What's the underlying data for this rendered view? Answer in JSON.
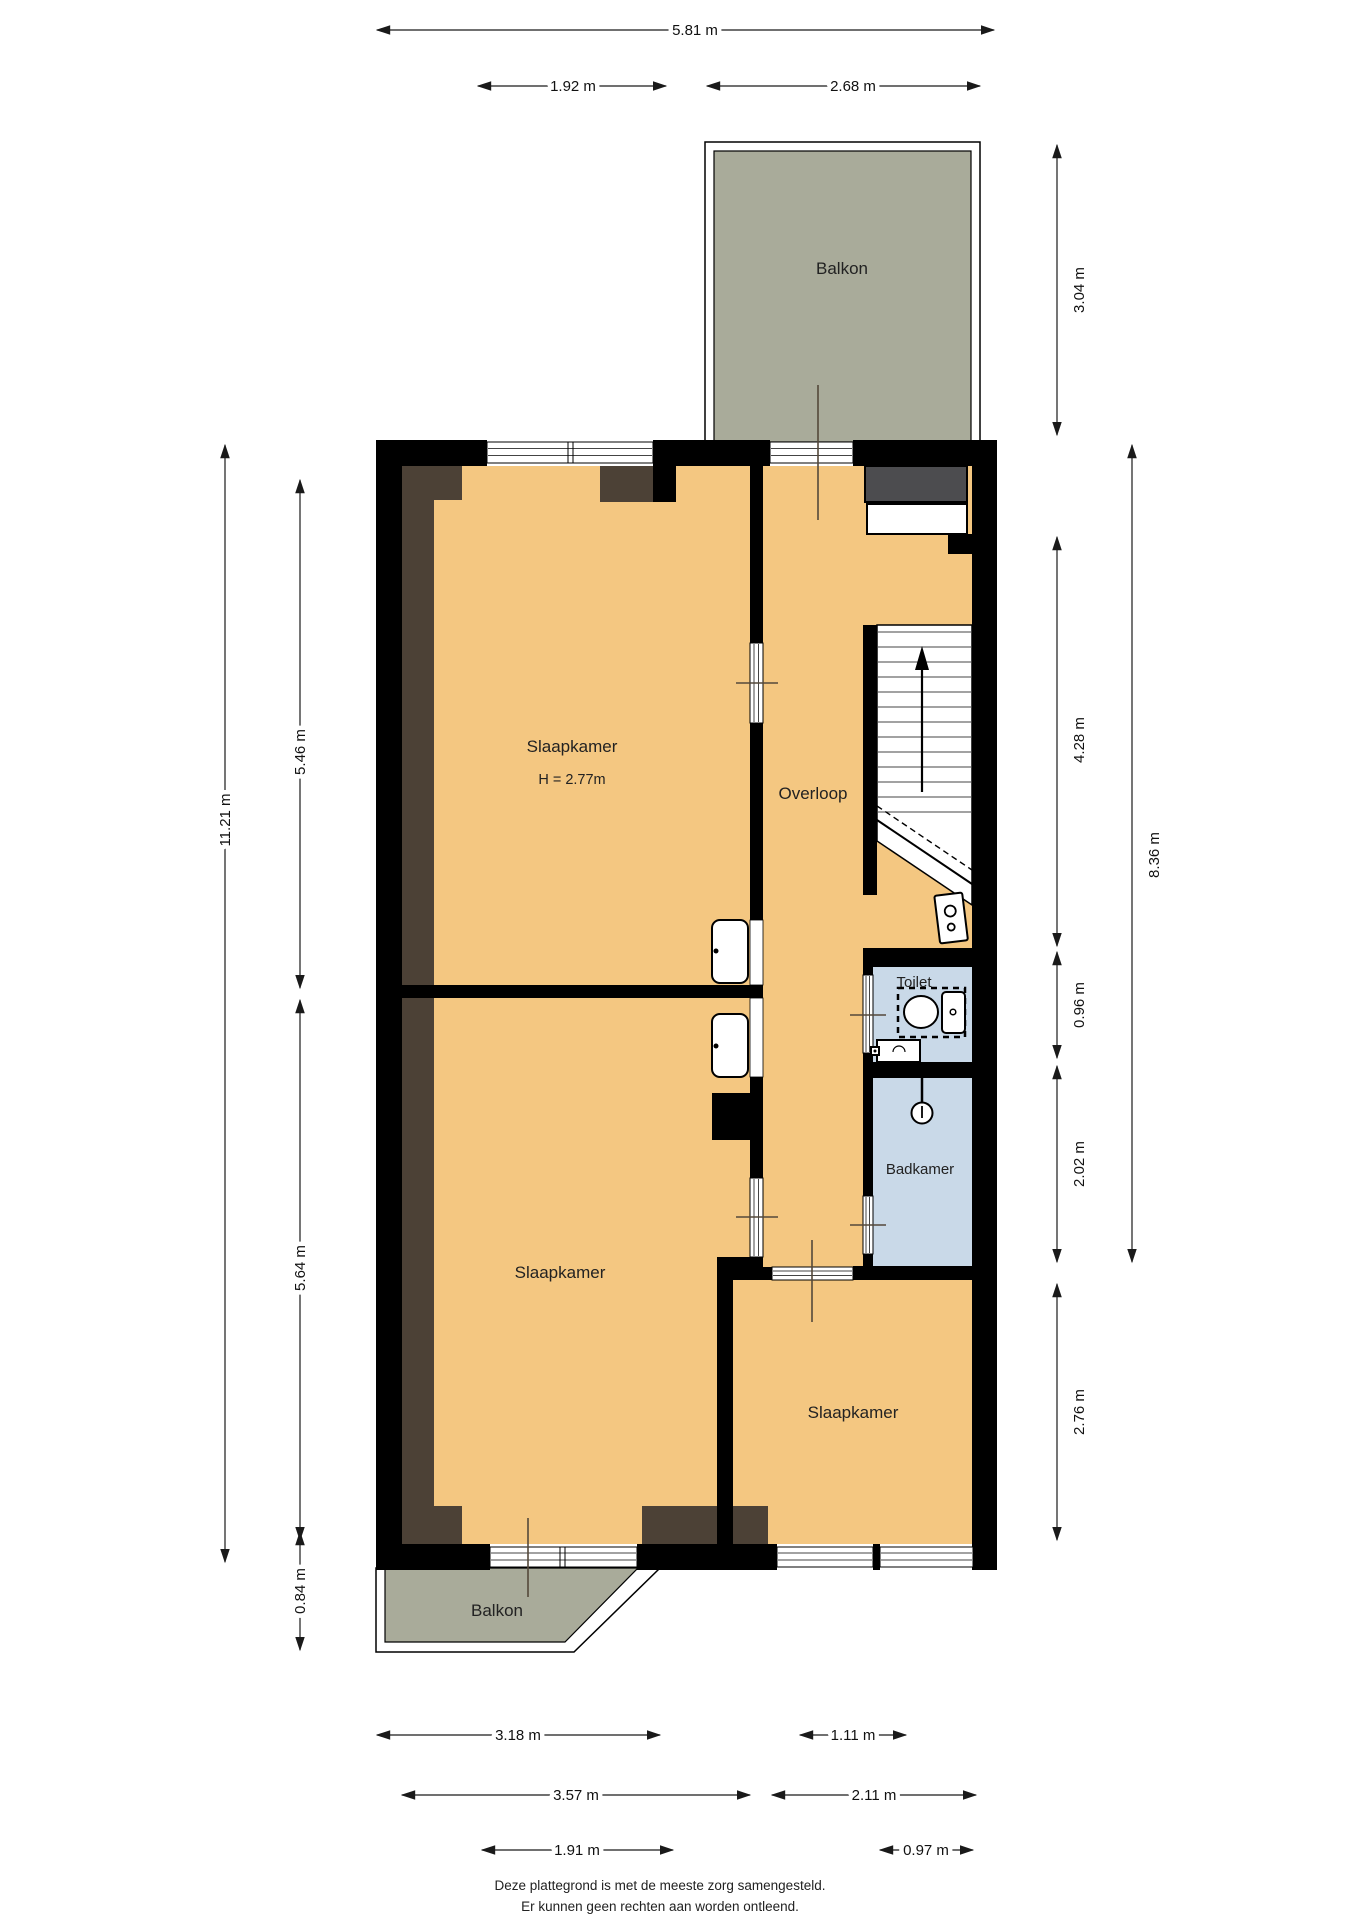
{
  "floorplan": {
    "labels": {
      "balkon_top": "Balkon",
      "slaapkamer1": "Slaapkamer",
      "slaapkamer1_height": "H = 2.77m",
      "overloop": "Overloop",
      "toilet": "Toilet",
      "badkamer": "Badkamer",
      "slaapkamer2": "Slaapkamer",
      "slaapkamer3": "Slaapkamer",
      "balkon_bottom": "Balkon"
    },
    "dimensions": {
      "total_width": "5.81 m",
      "window_top": "1.92 m",
      "balcony_top_width": "2.68 m",
      "balcony_top_depth": "3.04 m",
      "left_total": "11.21 m",
      "bedroom1_depth": "5.46 m",
      "bedroom2_depth": "5.64 m",
      "balcony_bottom_depth": "0.84 m",
      "overloop_depth": "4.28 m",
      "right_total": "8.36 m",
      "toilet_depth": "0.96 m",
      "badkamer_depth": "2.02 m",
      "bedroom3_depth": "2.76 m",
      "balcony_bottom_width": "3.18 m",
      "overloop_width": "1.11 m",
      "left_width": "3.57 m",
      "right_width": "2.11 m",
      "window_bottom_left": "1.91 m",
      "window_bottom_right": "0.97 m"
    },
    "footer": {
      "line1": "Deze plattegrond is met de meeste zorg samengesteld.",
      "line2": "Er kunnen geen rechten aan worden ontleend."
    },
    "colors": {
      "floor": "#f4c781",
      "wet_room": "#c9d9e8",
      "balcony": "#a9ab9a",
      "wall": "#000000",
      "wall_lining": "#4c4136",
      "niche": "#4c4c4f"
    }
  }
}
